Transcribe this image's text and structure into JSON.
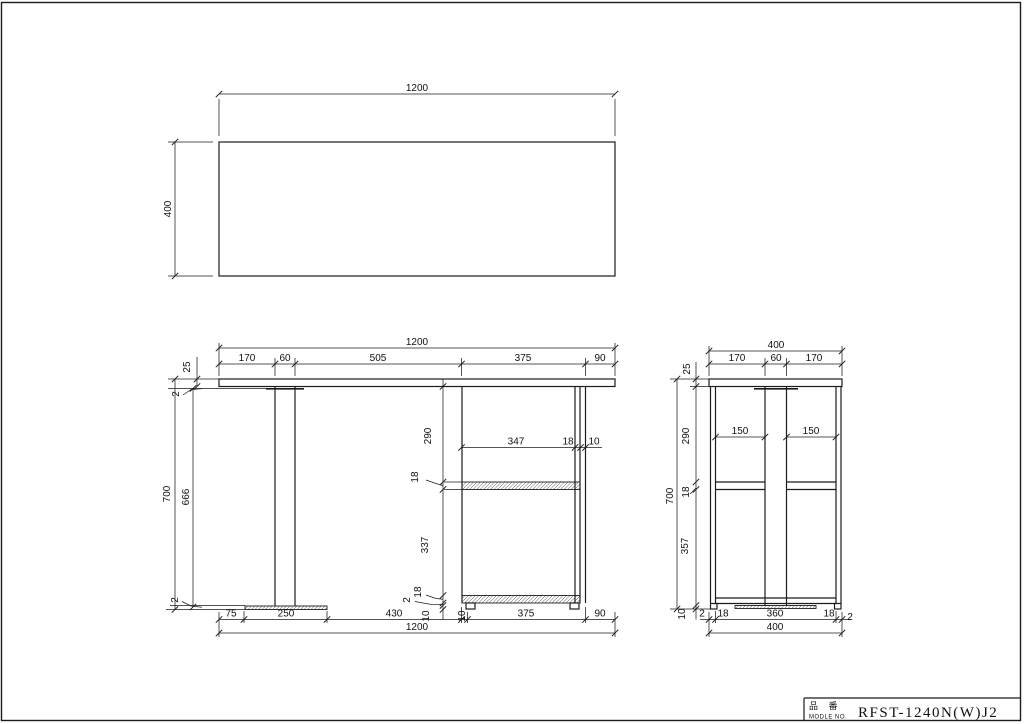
{
  "drawing": {
    "top_view": {
      "width": "1200",
      "depth": "400"
    },
    "front_view": {
      "top_total": "1200",
      "top_chain": [
        "170",
        "60",
        "505",
        "375",
        "90"
      ],
      "thickness": "25",
      "top_edge": "2",
      "height_total": "700",
      "height_inner": "666",
      "bottom_edge": "2",
      "vertical_chain": [
        "290",
        "18",
        "337",
        "18",
        "2",
        "10"
      ],
      "shelf_chain": [
        "347",
        "18",
        "10"
      ],
      "bottom_chain": [
        "75",
        "250",
        "430",
        "10",
        "375",
        "90"
      ],
      "bottom_total": "1200"
    },
    "side_view": {
      "top_total": "400",
      "top_chain": [
        "170",
        "60",
        "170"
      ],
      "thickness": "25",
      "vertical_chain": [
        "290",
        "18",
        "357",
        "10"
      ],
      "height_total": "700",
      "openings": [
        "150",
        "150"
      ],
      "bottom_chain": [
        "2",
        "18",
        "360",
        "18",
        "2"
      ],
      "bottom_total": "400"
    },
    "title_block": {
      "item_label_jp": "品 番",
      "item_label_en": "MODLE NO.",
      "model_no": "RFST-1240N(W)J2"
    },
    "colors": {
      "line": "#1c1c1c",
      "background": "#ffffff"
    }
  }
}
